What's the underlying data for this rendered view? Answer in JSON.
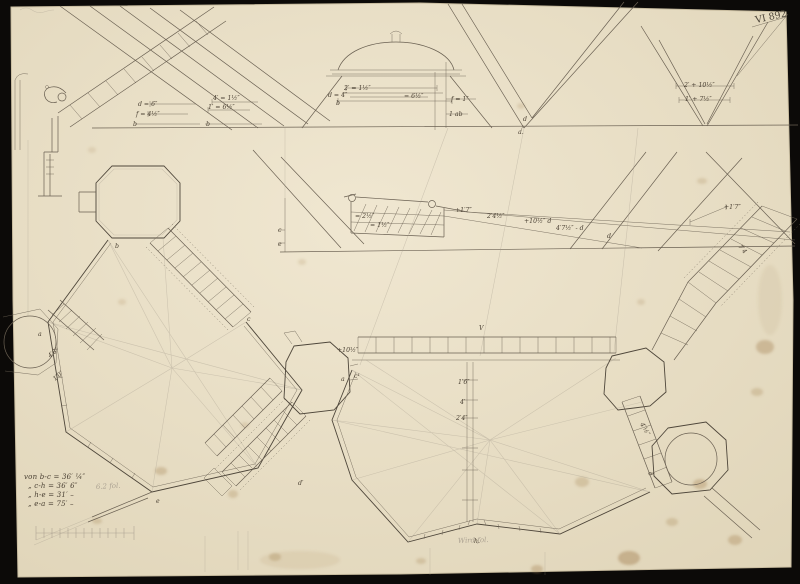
{
  "document": {
    "kind": "scanned architectural drawing (plan and roof sections of a fortified building)",
    "inventory_no": "VI 892"
  },
  "colors": {
    "bg": "#0c0a08",
    "paper_light": "#f0e7d1",
    "paper_dark": "#e0d5b9",
    "paper_edge": "#c9bda0",
    "ink": "#6a6052",
    "ink_strong": "#4e463a",
    "ink_text": "#4a4033",
    "pencil": "#a2988a",
    "stain": "#aa8a5c"
  },
  "notes": {
    "measure_lines": [
      "von b-c = 36′ ¼″",
      "„  c-h = 36′ 6″",
      "„  h-e = 31′ –",
      "„  e-a = 75′ –"
    ],
    "pencil_note_left": "6.2 fol.",
    "pencil_note_bottom": "Wird fol."
  },
  "annotations": {
    "labels": [
      {
        "text": "d = 6″",
        "x": 138,
        "y": 106
      },
      {
        "text": "f = 4½″",
        "x": 136,
        "y": 116
      },
      {
        "text": "b",
        "x": 133,
        "y": 126,
        "size": 7
      },
      {
        "text": "4′ = 1½″",
        "x": 213,
        "y": 100
      },
      {
        "text": "1′ = 6½″",
        "x": 208,
        "y": 109
      },
      {
        "text": "b",
        "x": 206,
        "y": 126,
        "size": 7
      },
      {
        "text": "2′ = 1½″",
        "x": 344,
        "y": 90
      },
      {
        "text": "d = 4″",
        "x": 328,
        "y": 97
      },
      {
        "text": "= 6½″",
        "x": 404,
        "y": 98
      },
      {
        "text": "b",
        "x": 336,
        "y": 105,
        "size": 7
      },
      {
        "text": "f = 1″",
        "x": 451,
        "y": 101
      },
      {
        "text": "1 ab",
        "x": 449,
        "y": 116
      },
      {
        "text": "d",
        "x": 523,
        "y": 121
      },
      {
        "text": "a.",
        "x": 518,
        "y": 134,
        "size": 7
      },
      {
        "text": "2′ + 10½″",
        "x": 684,
        "y": 87
      },
      {
        "text": "1′ + 7½″",
        "x": 685,
        "y": 101
      },
      {
        "text": "c",
        "x": 278,
        "y": 232
      },
      {
        "text": "e",
        "x": 278,
        "y": 246
      },
      {
        "text": "= 2½″",
        "x": 355,
        "y": 218
      },
      {
        "text": "= 1½″",
        "x": 370,
        "y": 227
      },
      {
        "text": "+1′7″",
        "x": 455,
        "y": 212
      },
      {
        "text": "2′4½″",
        "x": 487,
        "y": 218
      },
      {
        "text": "+10½″ d",
        "x": 524,
        "y": 223
      },
      {
        "text": "4′7½″ - d",
        "x": 556,
        "y": 230
      },
      {
        "text": "d",
        "x": 607,
        "y": 238
      },
      {
        "text": "V",
        "x": 479,
        "y": 330,
        "size": 7.5
      },
      {
        "text": "+10½″",
        "x": 337,
        "y": 352
      },
      {
        "text": "a",
        "x": 341,
        "y": 381
      },
      {
        "text": "c¹",
        "x": 354,
        "y": 378
      },
      {
        "text": "4′6″",
        "x": 50,
        "y": 358,
        "rot": -40
      },
      {
        "text": "1′0″",
        "x": 55,
        "y": 381,
        "rot": -40
      },
      {
        "text": "1′6″",
        "x": 458,
        "y": 384
      },
      {
        "text": "4′",
        "x": 460,
        "y": 404
      },
      {
        "text": "2′4″",
        "x": 456,
        "y": 420
      },
      {
        "text": "4′½″",
        "x": 640,
        "y": 424,
        "rot": 60
      },
      {
        "text": "d",
        "x": 648,
        "y": 473,
        "rot": 60
      },
      {
        "text": "+1′7″",
        "x": 724,
        "y": 209
      },
      {
        "text": "7′4",
        "x": 738,
        "y": 247,
        "rot": 48
      },
      {
        "text": "h.",
        "x": 474,
        "y": 543,
        "size": 7.5
      },
      {
        "text": "a",
        "x": 38,
        "y": 336,
        "size": 7
      },
      {
        "text": "b",
        "x": 115,
        "y": 248,
        "size": 7
      },
      {
        "text": "c",
        "x": 247,
        "y": 321,
        "size": 7
      },
      {
        "text": "e",
        "x": 156,
        "y": 503,
        "size": 7
      },
      {
        "text": "d′",
        "x": 298,
        "y": 485,
        "size": 7
      }
    ]
  }
}
